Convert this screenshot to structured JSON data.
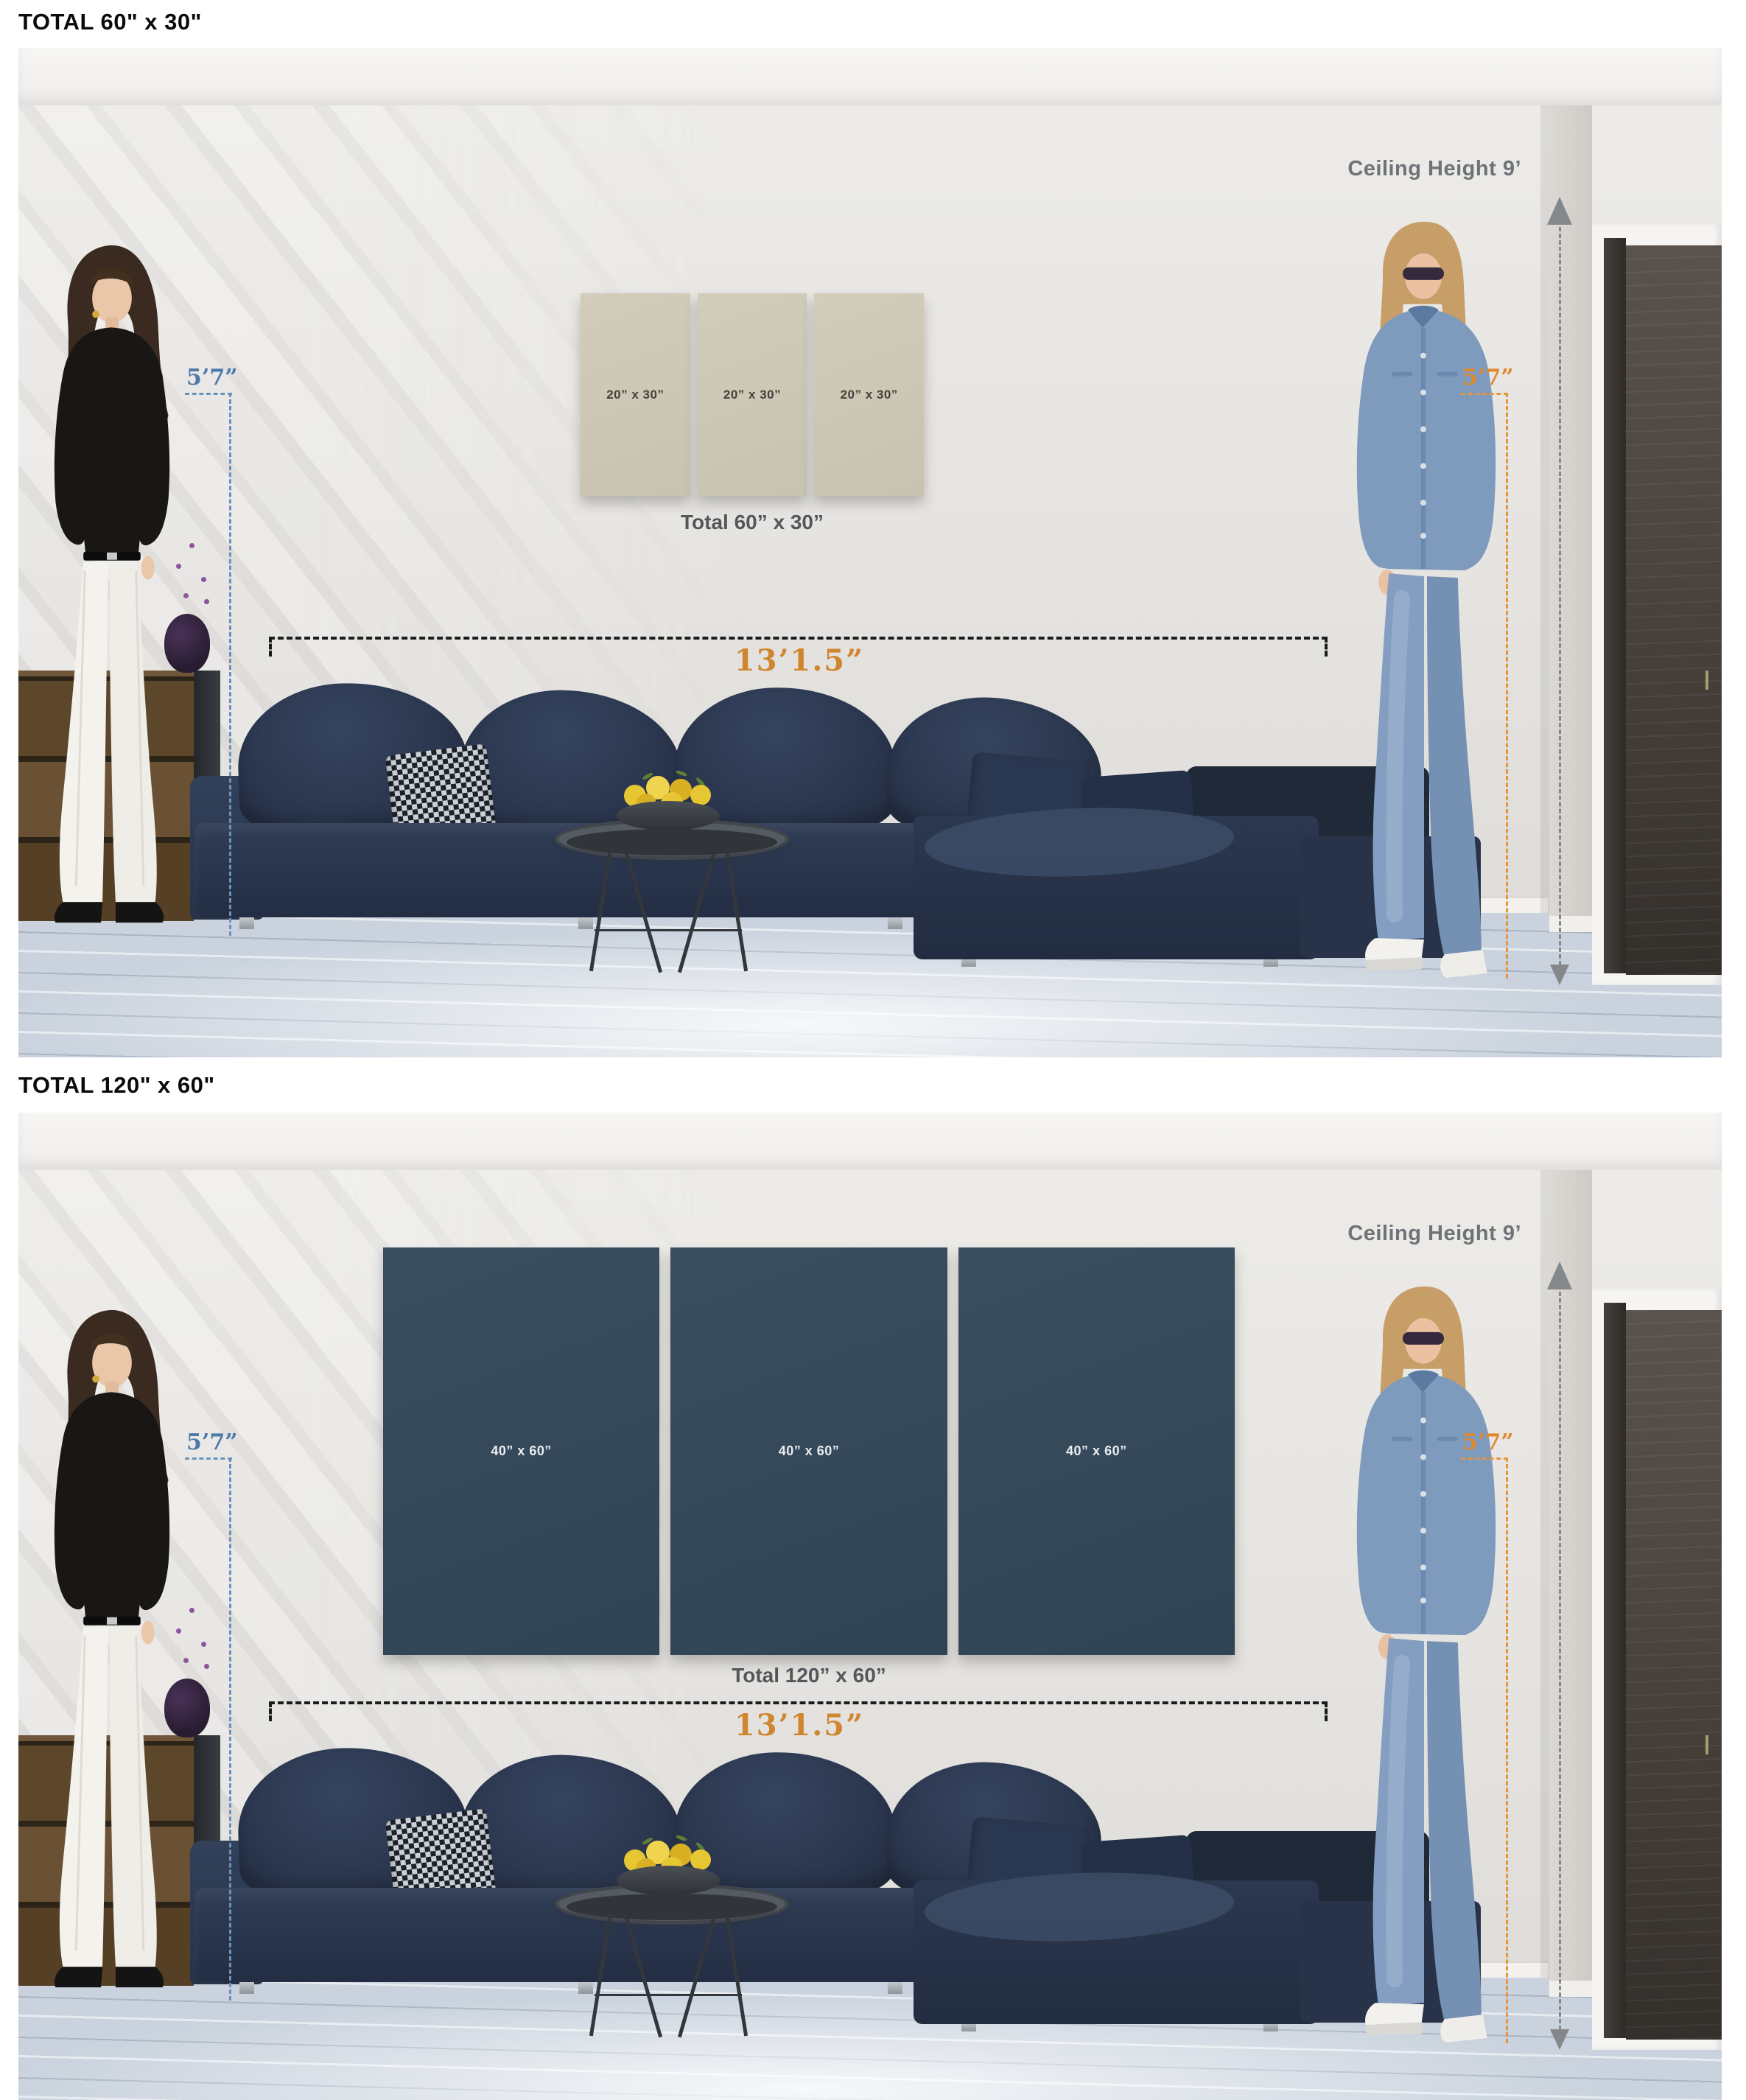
{
  "sections": [
    {
      "heading": "TOTAL 60\" x 30\"",
      "ceiling_label": "Ceiling Height 9’",
      "left_height_label": "5’7”",
      "right_height_label": "5’7”",
      "sofa_width_label": "13’1.5”",
      "panels": [
        {
          "label": "20” x 30”"
        },
        {
          "label": "20” x 30”"
        },
        {
          "label": "20” x 30”"
        }
      ],
      "total_caption": "Total 60” x 30”",
      "panel_color": "#cdc7b6",
      "panel_label_color": "#44413a"
    },
    {
      "heading": "TOTAL 120\" x 60\"",
      "ceiling_label": "Ceiling Height 9’",
      "left_height_label": "5’7”",
      "right_height_label": "5’7”",
      "sofa_width_label": "13’1.5”",
      "panels": [
        {
          "label": "40” x 60”"
        },
        {
          "label": "40” x 60”"
        },
        {
          "label": "40” x 60”"
        }
      ],
      "total_caption": "Total 120” x 60”",
      "panel_color": "#35495b",
      "panel_label_color": "#e9edf0"
    }
  ],
  "colors": {
    "measure_blue": "#4d79a8",
    "measure_orange": "#e8943d",
    "measure_gray": "#6d7377",
    "sofa_width_label_color": "#d0862f",
    "caption_gray": "#53575a",
    "sofa_navy": "#2d3950",
    "wall": "#e7e5e2",
    "floor": "#c9d2dd",
    "door_brown": "#413b36"
  }
}
